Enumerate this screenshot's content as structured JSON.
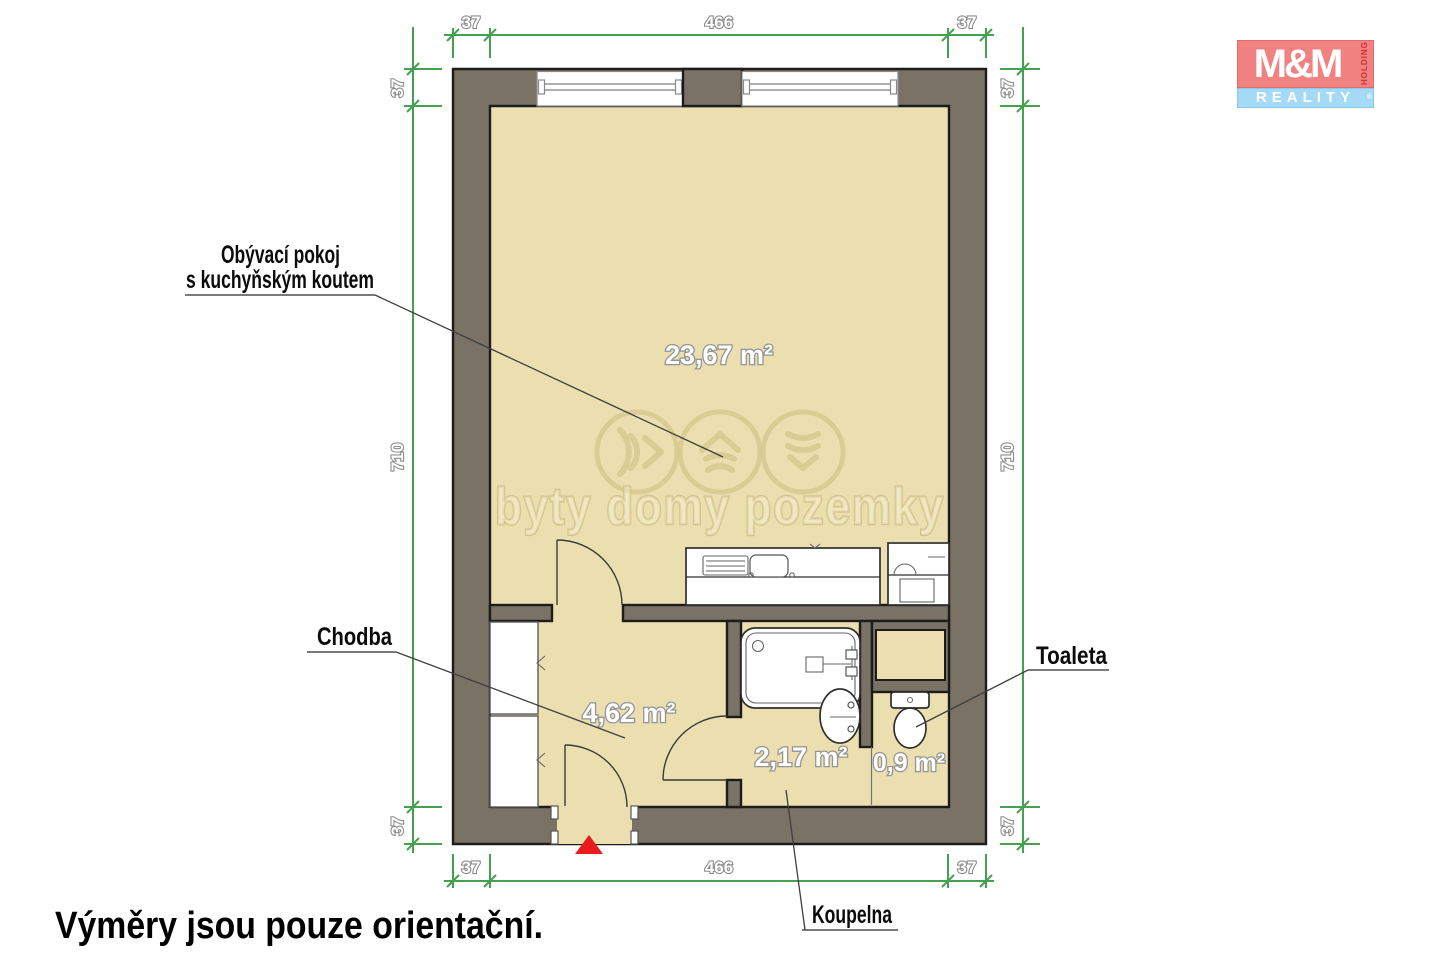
{
  "footer": {
    "note": "Výměry jsou pouze orientační."
  },
  "watermark": {
    "text": "byty domy pozemky"
  },
  "logo": {
    "top": "M&M",
    "side": "HOLDING",
    "bottom": "REALITY",
    "reg": "®"
  },
  "rooms": {
    "living": {
      "label_line1": "Obývací pokoj",
      "label_line2": "s kuchyňským koutem",
      "area": "23,67 m²"
    },
    "hall": {
      "label": "Chodba",
      "area": "4,62 m²"
    },
    "bathroom": {
      "label": "Koupelna",
      "area": "2,17 m²"
    },
    "toilet": {
      "label": "Toaleta",
      "area": "0,9 m²"
    }
  },
  "dimensions": {
    "top": [
      "37",
      "466",
      "37"
    ],
    "bottom": [
      "37",
      "466",
      "37"
    ],
    "left": [
      "37",
      "710",
      "37"
    ],
    "right": [
      "37",
      "710",
      "37"
    ]
  },
  "colors": {
    "wall": "#7a7265",
    "floor": "#ebdfb0",
    "dimension_green": "#45a14f",
    "watermark": "#d6c78e",
    "entrance_marker": "#e81c1c",
    "logo_pink": "#f28282",
    "logo_blue": "#a5daf6",
    "logo_red": "#cf2f2f"
  }
}
